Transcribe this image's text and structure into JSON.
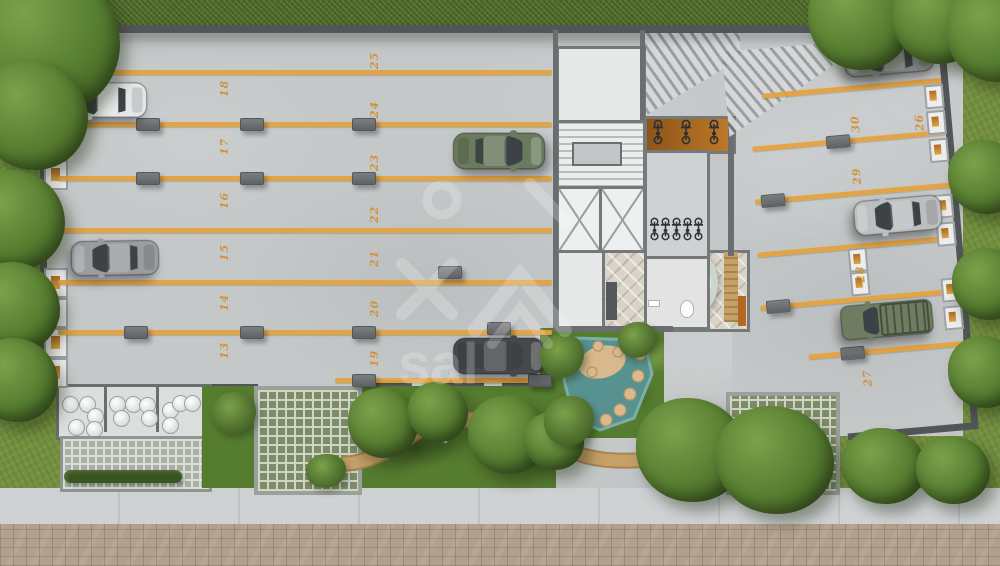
{
  "title": "ground-floor-site-plan-render",
  "watermark": {
    "text": "sal"
  },
  "parking": {
    "left": [
      "18",
      "17",
      "16",
      "15",
      "14",
      "13"
    ],
    "middle": [
      "25",
      "24",
      "23",
      "22",
      "21",
      "20",
      "19"
    ],
    "right": [
      "30",
      "29",
      "28",
      "27",
      "26"
    ]
  },
  "palette": {
    "grass": "#73903f",
    "grass_dark": "#5c7631",
    "hedge": "#55722e",
    "leaf": "#567c30",
    "leaf_light": "#7ba24a",
    "leaf_dark": "#39551f",
    "concrete": "#c5c8c9",
    "concrete_light": "#d3d5d6",
    "wall": "#6b6e70",
    "wall_dark": "#535658",
    "core_wall": "#76797b",
    "room_floor": "#e7e8e8",
    "orange_line": "#e6a23c",
    "stall_number": "#d28f2a",
    "orange_wall": "#b06a23",
    "wood": "#c7a068",
    "wood_dark": "#a8854f",
    "pond": "#589290",
    "pond_light": "#79b0aa",
    "sand": "#d8b88c",
    "tile": "#d9d3c8",
    "grate_green": "#7e8c6a",
    "grate_line": "#cfd6c4",
    "grate_frame": "#9aa09b",
    "street": "#b2a08c",
    "sidewalk": "#ced2d3",
    "curb": "#9aa0a2",
    "car_white": "#e4e6e7",
    "car_gray": "#9a9c9f",
    "car_green": "#6a7a5c",
    "car_dark": "#46484b",
    "car_slate": "#878b8d",
    "car_silver": "#bcbfc0",
    "car_pickup": "#6e7d61"
  }
}
